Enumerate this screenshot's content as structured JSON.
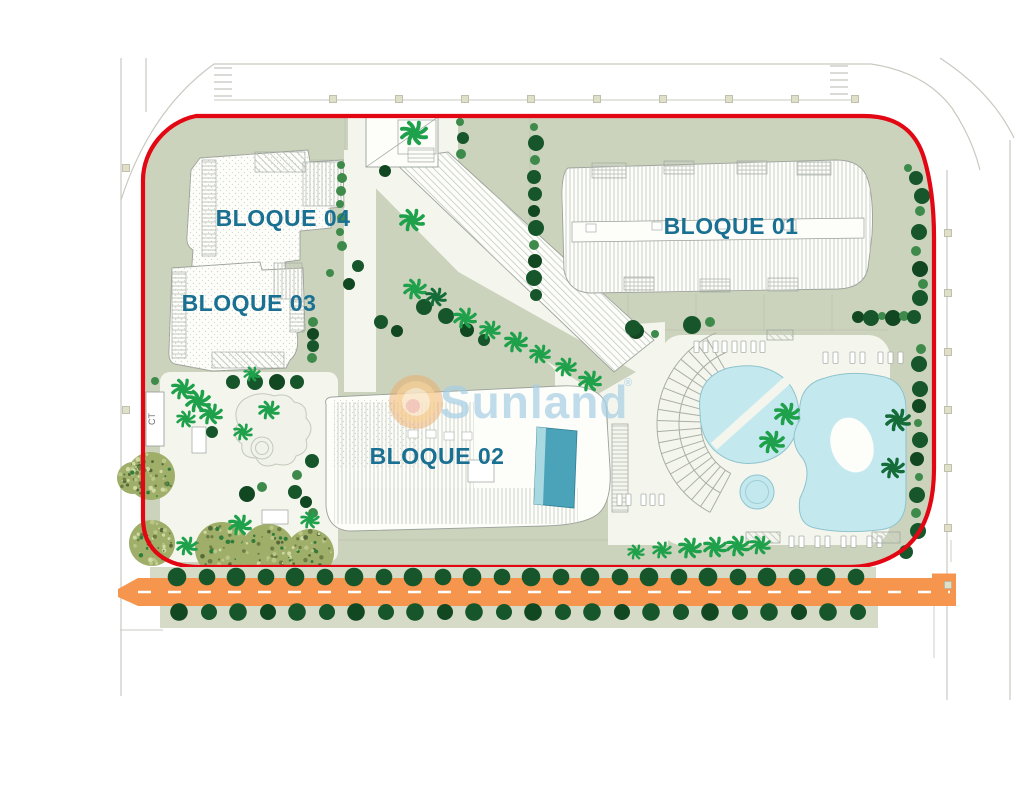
{
  "meta": {
    "title": "Residential development site plan",
    "plan_width": 1024,
    "plan_height": 800
  },
  "watermark": {
    "brand": "Sunland",
    "registered": "®"
  },
  "labels": {
    "bloque01": "BLOQUE 01",
    "bloque02": "BLOQUE 02",
    "bloque03": "BLOQUE 03",
    "bloque04": "BLOQUE 04",
    "ct": "CT"
  },
  "colors": {
    "boundary_red": "#e30613",
    "label_teal": "#1a7092",
    "road_orange": "#f6954e",
    "road_dash_white": "#ffffff",
    "site_sage": "#cbd3bc",
    "sage_light": "#d6dcc8",
    "paved_white": "#f4f6ee",
    "building_fill": "#fdfdfa",
    "building_stroke": "#9ba29b",
    "hatch_gray": "#c2c7bf",
    "pool_cyan": "#c3e9ef",
    "pool_stroke": "#8fc3cd",
    "lap_pool_teal": "#4aa3b8",
    "lap_pool_light": "#a8d8e0",
    "tree_dark": "#16562a",
    "tree_darker": "#114721",
    "tree_light": "#3e8a4b",
    "palm_bright": "#1fa14b",
    "palm_dark": "#156c38",
    "speckled_base": "#9fae68",
    "sun_ring": "#eda75f",
    "sun_mid": "#f7cf95",
    "sun_core": "#fbe8cd",
    "sun_center": "#f0b4ab",
    "brand_blue": "#a7cde4",
    "lamp_beige": "#e0dfc8",
    "outer_road_gray": "#c9c9c1"
  },
  "trees": {
    "round": [
      [
        908,
        168,
        4
      ],
      [
        916,
        178,
        7
      ],
      [
        922,
        196,
        8
      ],
      [
        920,
        211,
        5
      ],
      [
        919,
        232,
        8
      ],
      [
        916,
        251,
        5
      ],
      [
        920,
        269,
        8
      ],
      [
        923,
        284,
        5
      ],
      [
        920,
        298,
        8
      ],
      [
        921,
        349,
        5
      ],
      [
        919,
        364,
        8
      ],
      [
        920,
        389,
        8
      ],
      [
        919,
        406,
        7
      ],
      [
        918,
        423,
        4
      ],
      [
        920,
        440,
        8
      ],
      [
        917,
        459,
        7
      ],
      [
        919,
        477,
        4
      ],
      [
        917,
        495,
        8
      ],
      [
        916,
        513,
        5
      ],
      [
        918,
        531,
        8
      ],
      [
        906,
        552,
        7
      ],
      [
        858,
        317,
        6
      ],
      [
        871,
        318,
        8
      ],
      [
        882,
        316,
        4
      ],
      [
        893,
        318,
        8
      ],
      [
        904,
        316,
        5
      ],
      [
        914,
        317,
        7
      ],
      [
        636,
        331,
        8
      ],
      [
        655,
        334,
        4
      ],
      [
        692,
        325,
        9
      ],
      [
        710,
        322,
        5
      ],
      [
        534,
        127,
        4
      ],
      [
        536,
        143,
        8
      ],
      [
        535,
        160,
        5
      ],
      [
        534,
        177,
        7
      ],
      [
        535,
        194,
        7
      ],
      [
        534,
        211,
        6
      ],
      [
        536,
        228,
        8
      ],
      [
        534,
        245,
        5
      ],
      [
        535,
        261,
        7
      ],
      [
        534,
        278,
        8
      ],
      [
        536,
        295,
        6
      ],
      [
        460,
        122,
        4
      ],
      [
        463,
        138,
        6
      ],
      [
        461,
        154,
        5
      ],
      [
        385,
        171,
        6
      ],
      [
        341,
        165,
        4
      ],
      [
        342,
        178,
        5
      ],
      [
        341,
        191,
        5
      ],
      [
        340,
        204,
        4
      ],
      [
        342,
        218,
        5
      ],
      [
        340,
        232,
        4
      ],
      [
        342,
        246,
        5
      ],
      [
        358,
        266,
        6
      ],
      [
        349,
        284,
        6
      ],
      [
        330,
        273,
        4
      ],
      [
        313,
        322,
        5
      ],
      [
        313,
        334,
        6
      ],
      [
        313,
        346,
        6
      ],
      [
        312,
        358,
        5
      ],
      [
        155,
        381,
        4
      ],
      [
        233,
        382,
        7
      ],
      [
        255,
        382,
        8
      ],
      [
        277,
        382,
        8
      ],
      [
        297,
        382,
        7
      ],
      [
        381,
        322,
        7
      ],
      [
        397,
        331,
        6
      ],
      [
        424,
        307,
        8
      ],
      [
        446,
        316,
        8
      ],
      [
        467,
        330,
        7
      ],
      [
        484,
        340,
        6
      ],
      [
        633,
        328,
        8
      ],
      [
        247,
        494,
        8
      ],
      [
        262,
        487,
        5
      ],
      [
        295,
        492,
        7
      ],
      [
        306,
        502,
        6
      ],
      [
        312,
        461,
        7
      ],
      [
        297,
        475,
        5
      ],
      [
        313,
        513,
        5
      ],
      [
        212,
        432,
        6
      ]
    ],
    "street_top_y": 577,
    "street_top_x": [
      177,
      207,
      236,
      266,
      295,
      325,
      354,
      384,
      413,
      443,
      472,
      502,
      531,
      561,
      590,
      620,
      649,
      679,
      708,
      738,
      767,
      797,
      826,
      856
    ],
    "street_bottom_y": 612,
    "street_bottom_x": [
      179,
      209,
      238,
      268,
      297,
      327,
      356,
      386,
      415,
      445,
      474,
      504,
      533,
      563,
      592,
      622,
      651,
      681,
      710,
      740,
      769,
      799,
      828,
      858
    ],
    "palms": [
      [
        414,
        133,
        13,
        "b"
      ],
      [
        412,
        220,
        12,
        "b"
      ],
      [
        415,
        289,
        11,
        "b"
      ],
      [
        436,
        297,
        10,
        "d"
      ],
      [
        465,
        318,
        11,
        "b"
      ],
      [
        490,
        330,
        10,
        "b"
      ],
      [
        516,
        342,
        11,
        "b"
      ],
      [
        540,
        354,
        10,
        "b"
      ],
      [
        566,
        367,
        10,
        "b"
      ],
      [
        590,
        381,
        11,
        "b"
      ],
      [
        183,
        389,
        11,
        "b"
      ],
      [
        198,
        401,
        12,
        "b"
      ],
      [
        211,
        414,
        11,
        "b"
      ],
      [
        186,
        419,
        9,
        "b"
      ],
      [
        269,
        410,
        10,
        "b"
      ],
      [
        243,
        432,
        9,
        "b"
      ],
      [
        252,
        374,
        8,
        "b"
      ],
      [
        240,
        525,
        11,
        "b"
      ],
      [
        310,
        520,
        9,
        "b"
      ],
      [
        187,
        546,
        10,
        "b"
      ],
      [
        787,
        414,
        12,
        "b"
      ],
      [
        772,
        442,
        12,
        "b"
      ],
      [
        898,
        420,
        12,
        "d"
      ],
      [
        893,
        468,
        11,
        "d"
      ],
      [
        636,
        552,
        8,
        "b"
      ],
      [
        662,
        550,
        9,
        "b"
      ],
      [
        690,
        548,
        11,
        "b"
      ],
      [
        715,
        547,
        11,
        "b"
      ],
      [
        738,
        546,
        11,
        "b"
      ],
      [
        760,
        545,
        10,
        "b"
      ]
    ],
    "speckled": [
      [
        151,
        476,
        24
      ],
      [
        152,
        543,
        23
      ],
      [
        222,
        549,
        27
      ],
      [
        268,
        551,
        27
      ],
      [
        310,
        553,
        24
      ],
      [
        133,
        478,
        16
      ]
    ]
  },
  "lamps": {
    "top": {
      "y": 99,
      "x": [
        333,
        399,
        465,
        531,
        597,
        663,
        729,
        795,
        855
      ]
    },
    "right": {
      "x": 948,
      "y": [
        233,
        293,
        352,
        410,
        468,
        528,
        585
      ]
    },
    "left": {
      "x": 126,
      "y": [
        168,
        410
      ]
    }
  },
  "loungers": [
    [
      694,
      341
    ],
    [
      703,
      341
    ],
    [
      713,
      341
    ],
    [
      722,
      341
    ],
    [
      732,
      341
    ],
    [
      741,
      341
    ],
    [
      751,
      341
    ],
    [
      760,
      341
    ],
    [
      823,
      352
    ],
    [
      833,
      352
    ],
    [
      850,
      352
    ],
    [
      860,
      352
    ],
    [
      878,
      352
    ],
    [
      888,
      352
    ],
    [
      898,
      352
    ],
    [
      789,
      536
    ],
    [
      799,
      536
    ],
    [
      815,
      536
    ],
    [
      825,
      536
    ],
    [
      841,
      536
    ],
    [
      851,
      536
    ],
    [
      867,
      536
    ],
    [
      877,
      536
    ],
    [
      617,
      494
    ],
    [
      626,
      494
    ],
    [
      641,
      494
    ],
    [
      650,
      494
    ],
    [
      659,
      494
    ]
  ],
  "pergolas": [
    [
      746,
      532,
      34,
      11
    ],
    [
      872,
      532,
      28,
      11
    ],
    [
      767,
      330,
      26,
      10
    ]
  ]
}
